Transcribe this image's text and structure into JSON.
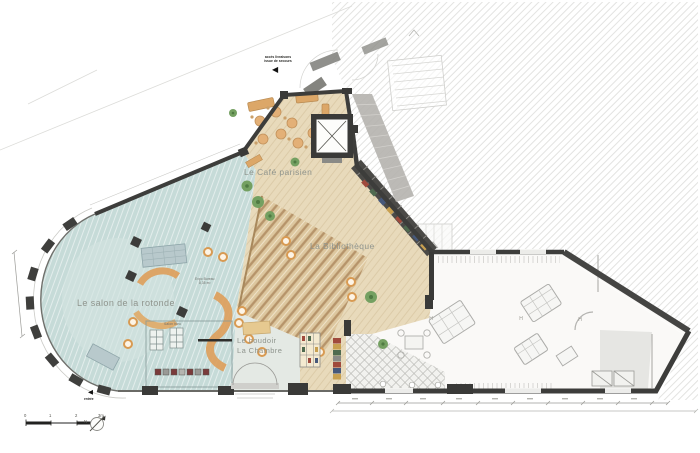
{
  "rooms": {
    "cafe": "Le Café parisien",
    "bibliotheque": "La Bibliothèque",
    "rotonde": "Le salon de la rotonde",
    "boudoir": "Le boudoir",
    "chambre": "La Chambre"
  },
  "small_labels": {
    "salon_bleu": "Salon bleu",
    "expo_line1": "Expo Bureau",
    "expo_line2": "8,35 m²"
  },
  "annotations": {
    "note_line1": "accès livraisons",
    "note_line2": "issue de secours",
    "note_arrow": "◀",
    "entrance_arrow": "◀",
    "entrance": "entrée"
  },
  "markers": {
    "north": "N",
    "door_handle": "H"
  },
  "scale_bar": {
    "ticks": [
      "0",
      "1",
      "2",
      "3m"
    ]
  },
  "palette": {
    "wall_dark": "#3d3d3b",
    "teal_floor": "#c6dbd8",
    "wood_floor": "#e8dabb",
    "gradins_tan": "#ddc79f",
    "furniture_orange": "#dd9f5c",
    "plant_green": "#74a061"
  }
}
